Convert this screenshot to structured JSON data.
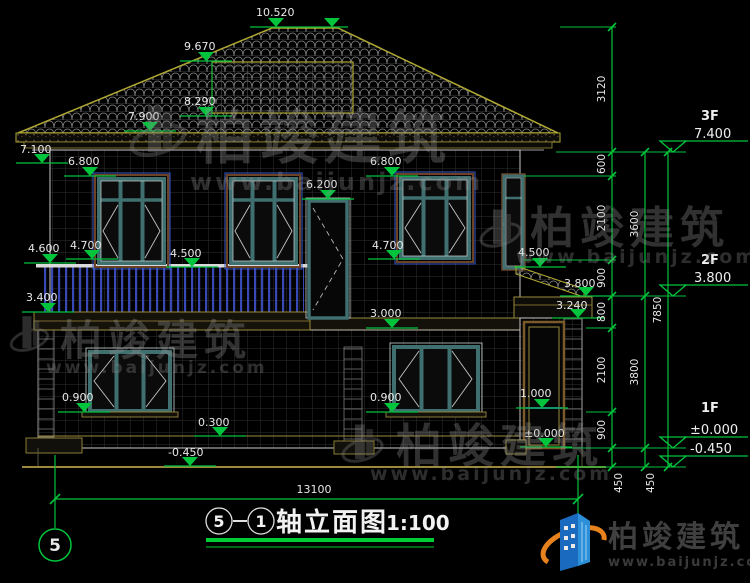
{
  "colors": {
    "background": "#000000",
    "dim_green": "#00c43c",
    "roof_yellow": "#b0a832",
    "trim_tan": "#9a8a3a",
    "window_teal": "#3f6f6f",
    "railing_blue": "#3848b4",
    "door_brown": "#7a5a2a",
    "text_white": "#e8e8e8",
    "logo_blue": "#1a6abf",
    "logo_orange": "#e8821e"
  },
  "elevations": {
    "ridge": "10.520",
    "dormer_top": "9.670",
    "dormer_eave": "8.290",
    "eave_top": "7.900",
    "eave_bottom": "7.100",
    "window_head_left": "6.800",
    "window_head_right": "6.800",
    "door_head": "6.200",
    "balcony_rail_corner": "4.600",
    "window_sill_left": "4.700",
    "balcony_rail_mid": "4.500",
    "window_sill_right": "4.700",
    "window_sill_far_right": "4.500",
    "annex_eave_top": "3.800",
    "bay_cornice": "3.400",
    "annex_eave_bottom": "3.240",
    "floor_band": "3.000",
    "annex_rail": "1.000",
    "sill_1f_left": "0.900",
    "sill_1f_right": "0.900",
    "plinth": "0.300",
    "annex_floor": "±0.000",
    "grade": "-0.450"
  },
  "dims": {
    "chain_a": [
      "3120",
      "600",
      "2100",
      "900",
      "800",
      "2100",
      "900"
    ],
    "chain_a_bottom": "450",
    "chain_b": [
      "3600",
      "3800"
    ],
    "chain_b_bottom": "450",
    "chain_total": "7850",
    "total_width": "13100"
  },
  "levels": {
    "f3_label": "3F",
    "f3_value": "7.400",
    "f2_label": "2F",
    "f2_value": "3.800",
    "f1_label": "1F",
    "f1_value": "±0.000",
    "grade_value": "-0.450"
  },
  "footer": {
    "axis_bubble": "5",
    "axis_start": "5",
    "axis_end": "1",
    "title": "轴立面图",
    "scale": "1:100"
  },
  "watermark": {
    "brand": "柏竣建筑",
    "url": "www.baijunjz.com"
  },
  "logo": {
    "brand": "柏竣建筑",
    "url": "www.baijunjz.com"
  }
}
